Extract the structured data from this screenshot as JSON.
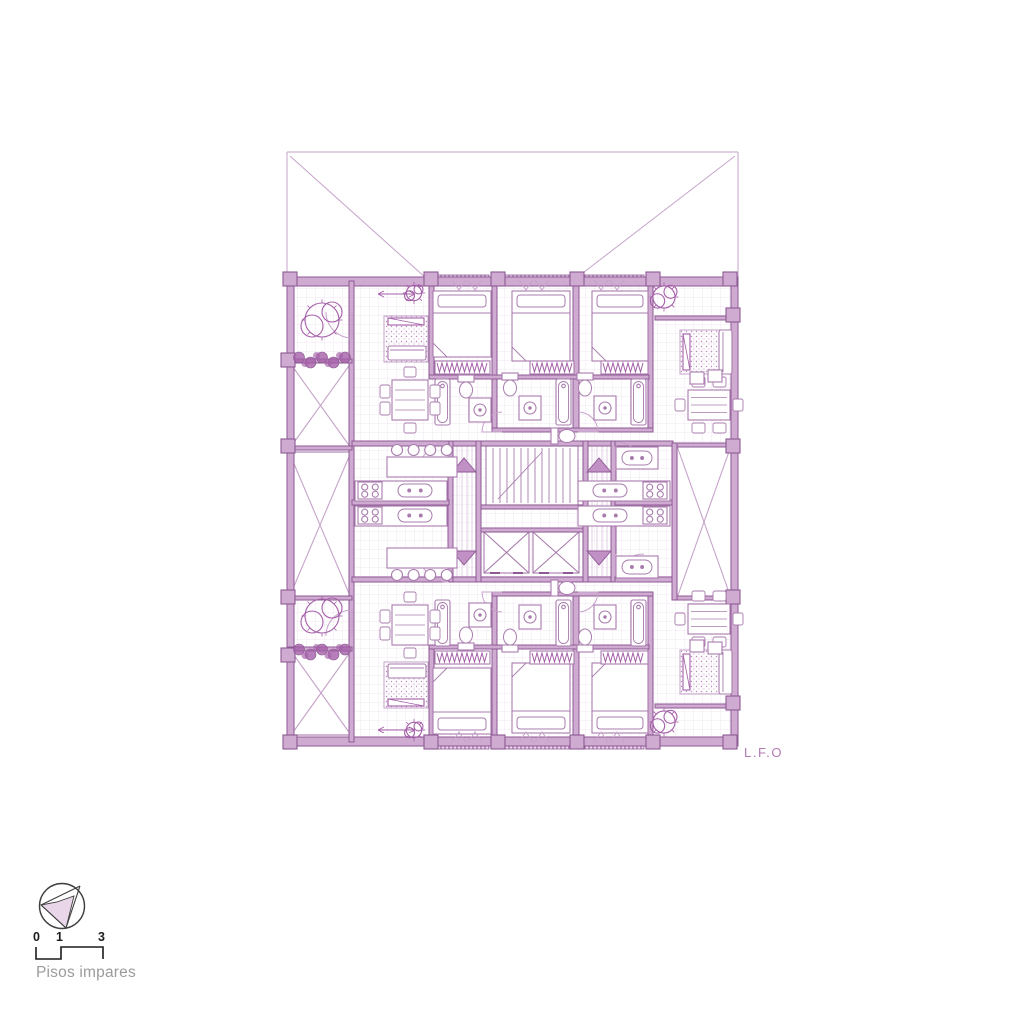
{
  "colors": {
    "line": "#a87bad",
    "line_light": "#c6a3ca",
    "wall_fill": "#cfaad1",
    "wall_stroke": "#8e5a94",
    "dark": "#a45fa8",
    "arrow_fill": "#c191c5",
    "shade": "#e9d6e9",
    "grid": "#efe3f1",
    "gray_text": "#9b9b9b",
    "black_text": "#1c1c1c",
    "label_purple": "#b47ab4",
    "bg": "#ffffff"
  },
  "legend": {
    "floor_label": "Pisos impares",
    "scale_ticks": [
      "0",
      "1",
      "3"
    ]
  },
  "plan": {
    "label": "L.F.O",
    "grid_area": [
      294,
      286,
      437,
      451
    ],
    "lot": [
      [
        287,
        152,
        738,
        152
      ],
      [
        287,
        152,
        287,
        281
      ],
      [
        738,
        152,
        738,
        281
      ],
      [
        290,
        156,
        427,
        279
      ],
      [
        735,
        156,
        575,
        279
      ]
    ],
    "walls": [
      [
        287,
        277,
        451,
        9
      ],
      [
        287,
        737,
        451,
        9
      ],
      [
        287,
        277,
        7,
        469
      ],
      [
        731,
        277,
        7,
        469
      ],
      [
        349,
        281,
        5,
        461
      ],
      [
        448,
        441,
        167,
        5
      ],
      [
        448,
        577,
        167,
        5
      ],
      [
        448,
        441,
        5,
        141
      ],
      [
        476,
        441,
        5,
        141
      ],
      [
        583,
        441,
        5,
        141
      ],
      [
        611,
        441,
        5,
        141
      ],
      [
        352,
        441,
        97,
        5
      ],
      [
        615,
        441,
        58,
        5
      ],
      [
        352,
        577,
        97,
        5
      ],
      [
        615,
        577,
        58,
        5
      ],
      [
        352,
        500,
        97,
        5
      ],
      [
        615,
        500,
        58,
        5
      ],
      [
        429,
        281,
        5,
        96
      ],
      [
        492,
        281,
        5,
        151
      ],
      [
        573,
        281,
        6,
        151
      ],
      [
        648,
        281,
        5,
        151
      ],
      [
        429,
        647,
        5,
        95
      ],
      [
        492,
        592,
        5,
        151
      ],
      [
        573,
        592,
        6,
        151
      ],
      [
        648,
        592,
        5,
        151
      ],
      [
        429,
        375,
        220,
        4
      ],
      [
        492,
        428,
        161,
        4
      ],
      [
        429,
        645,
        220,
        4
      ],
      [
        492,
        592,
        161,
        4
      ],
      [
        655,
        316,
        77,
        4
      ],
      [
        655,
        704,
        77,
        4
      ],
      [
        481,
        505,
        102,
        4
      ],
      [
        481,
        528,
        102,
        4
      ],
      [
        287,
        359,
        65,
        4
      ],
      [
        287,
        446,
        65,
        4
      ],
      [
        287,
        596,
        65,
        4
      ],
      [
        287,
        647,
        65,
        4
      ],
      [
        672,
        443,
        60,
        4
      ],
      [
        672,
        596,
        60,
        4
      ],
      [
        672,
        443,
        5,
        157
      ]
    ],
    "cols": [
      [
        283,
        272
      ],
      [
        424,
        272
      ],
      [
        491,
        272
      ],
      [
        570,
        272
      ],
      [
        646,
        272
      ],
      [
        723,
        272
      ],
      [
        283,
        735
      ],
      [
        424,
        735
      ],
      [
        491,
        735
      ],
      [
        570,
        735
      ],
      [
        646,
        735
      ],
      [
        723,
        735
      ],
      [
        281,
        353
      ],
      [
        281,
        439
      ],
      [
        281,
        590
      ],
      [
        281,
        648
      ],
      [
        726,
        308
      ],
      [
        726,
        439
      ],
      [
        726,
        590
      ],
      [
        726,
        696
      ]
    ],
    "rail": [
      [
        436,
        275,
        53,
        11
      ],
      [
        503,
        275,
        66,
        11
      ],
      [
        582,
        275,
        62,
        11
      ],
      [
        436,
        738,
        53,
        11
      ],
      [
        503,
        738,
        66,
        11
      ],
      [
        582,
        738,
        62,
        11
      ]
    ],
    "corr": [
      [
        453,
        446,
        23,
        131
      ],
      [
        588,
        446,
        23,
        131
      ]
    ],
    "shafts": [
      [
        290,
        363,
        61,
        85
      ],
      [
        289,
        452,
        62,
        146
      ],
      [
        291,
        651,
        60,
        84
      ],
      [
        677,
        446,
        54,
        152
      ]
    ],
    "lifts": [
      [
        484,
        532,
        45,
        41
      ],
      [
        533,
        532,
        46,
        41
      ]
    ],
    "stair": [
      486,
      446,
      92,
      59
    ],
    "arrows": [
      [
        464,
        465,
        1
      ],
      [
        599,
        465,
        1
      ],
      [
        464,
        558,
        0
      ],
      [
        599,
        558,
        0
      ]
    ],
    "doors": [
      [
        448,
        470,
        28,
        270,
        180
      ],
      [
        448,
        554,
        28,
        90,
        180
      ],
      [
        616,
        470,
        28,
        270,
        360
      ],
      [
        616,
        554,
        28,
        90,
        360
      ],
      [
        502,
        432,
        20,
        180,
        270
      ],
      [
        578,
        432,
        20,
        360,
        270
      ],
      [
        502,
        592,
        20,
        180,
        90
      ],
      [
        578,
        592,
        20,
        0,
        90
      ],
      [
        352,
        312,
        26,
        90,
        180
      ],
      [
        352,
        636,
        26,
        270,
        180
      ]
    ],
    "beds": [
      [
        433,
        291,
        58,
        66,
        1
      ],
      [
        512,
        291,
        58,
        70,
        1
      ],
      [
        592,
        291,
        56,
        70,
        1
      ],
      [
        433,
        668,
        58,
        66,
        0
      ],
      [
        512,
        663,
        58,
        70,
        0
      ],
      [
        592,
        663,
        56,
        70,
        0
      ]
    ],
    "closets": [
      [
        435,
        361,
        55,
        13
      ],
      [
        530,
        361,
        44,
        13
      ],
      [
        601,
        361,
        47,
        13
      ],
      [
        435,
        651,
        55,
        13
      ],
      [
        530,
        651,
        44,
        13
      ],
      [
        601,
        651,
        47,
        13
      ]
    ],
    "tubs": [
      [
        435,
        379,
        15,
        46
      ],
      [
        556,
        379,
        15,
        46
      ],
      [
        631,
        379,
        15,
        46
      ],
      [
        435,
        600,
        15,
        46
      ],
      [
        556,
        600,
        15,
        46
      ],
      [
        631,
        600,
        15,
        46
      ]
    ],
    "toilets": [
      [
        466,
        390,
        "S"
      ],
      [
        510,
        388,
        "S"
      ],
      [
        585,
        388,
        "S"
      ],
      [
        566,
        436,
        "E"
      ],
      [
        466,
        635,
        "N"
      ],
      [
        510,
        637,
        "N"
      ],
      [
        585,
        637,
        "N"
      ],
      [
        566,
        588,
        "E"
      ]
    ],
    "sinks": [
      [
        480,
        410
      ],
      [
        530,
        408
      ],
      [
        605,
        408
      ],
      [
        480,
        615
      ],
      [
        530,
        617
      ],
      [
        605,
        617
      ]
    ],
    "dsinks": [
      [
        398,
        484,
        34,
        13
      ],
      [
        398,
        509,
        34,
        13
      ],
      [
        593,
        484,
        34,
        13
      ],
      [
        593,
        509,
        34,
        13
      ],
      [
        622,
        451,
        30,
        14
      ],
      [
        622,
        560,
        30,
        14
      ]
    ],
    "counters": [
      [
        355,
        481,
        92,
        20
      ],
      [
        355,
        506,
        92,
        20
      ],
      [
        578,
        481,
        92,
        20
      ],
      [
        578,
        506,
        92,
        20
      ],
      [
        616,
        447,
        42,
        22
      ],
      [
        616,
        556,
        42,
        22
      ]
    ],
    "stoves": [
      [
        358,
        482,
        24,
        17
      ],
      [
        358,
        507,
        24,
        17
      ],
      [
        643,
        482,
        24,
        17
      ],
      [
        643,
        507,
        24,
        17
      ]
    ],
    "bars": [
      [
        387,
        457,
        70,
        20,
        1
      ],
      [
        387,
        548,
        70,
        20,
        0
      ]
    ],
    "rugs": [
      [
        384,
        316,
        44,
        46
      ],
      [
        384,
        662,
        44,
        46
      ],
      [
        680,
        330,
        46,
        44
      ],
      [
        680,
        650,
        46,
        44
      ]
    ],
    "sofas": [
      [
        388,
        346,
        38,
        14,
        0
      ],
      [
        388,
        664,
        38,
        14,
        0
      ],
      [
        719,
        330,
        13,
        44,
        1
      ],
      [
        719,
        650,
        13,
        44,
        1
      ]
    ],
    "tvs": [
      [
        388,
        318,
        36,
        7
      ],
      [
        388,
        699,
        36,
        7
      ],
      [
        683,
        334,
        7,
        36
      ],
      [
        683,
        654,
        7,
        36
      ]
    ],
    "tables": [
      [
        392,
        380,
        36,
        40
      ],
      [
        392,
        605,
        36,
        40
      ],
      [
        688,
        390,
        42,
        30
      ],
      [
        688,
        604,
        42,
        30
      ]
    ],
    "plants": [
      [
        322,
        320,
        20
      ],
      [
        322,
        616,
        20
      ],
      [
        664,
        297,
        13
      ],
      [
        664,
        722,
        13
      ],
      [
        414,
        293,
        9
      ],
      [
        414,
        730,
        9
      ]
    ],
    "prow": [
      [
        292,
        353,
        58,
        13
      ],
      [
        292,
        645,
        58,
        13
      ]
    ],
    "sides": [
      [
        690,
        372,
        14,
        12
      ],
      [
        708,
        370,
        14,
        12
      ],
      [
        690,
        640,
        14,
        12
      ],
      [
        708,
        642,
        14,
        12
      ]
    ],
    "vmarks": [
      [
        452,
        280,
        1
      ],
      [
        468,
        280,
        1
      ],
      [
        519,
        280,
        1
      ],
      [
        535,
        280,
        1
      ],
      [
        594,
        280,
        1
      ],
      [
        610,
        280,
        1
      ],
      [
        452,
        742,
        0
      ],
      [
        468,
        742,
        0
      ],
      [
        519,
        742,
        0
      ],
      [
        535,
        742,
        0
      ],
      [
        594,
        742,
        0
      ],
      [
        610,
        742,
        0
      ]
    ],
    "tracks": [
      [
        378,
        294,
        415,
        294
      ],
      [
        378,
        730,
        415,
        730
      ]
    ]
  }
}
